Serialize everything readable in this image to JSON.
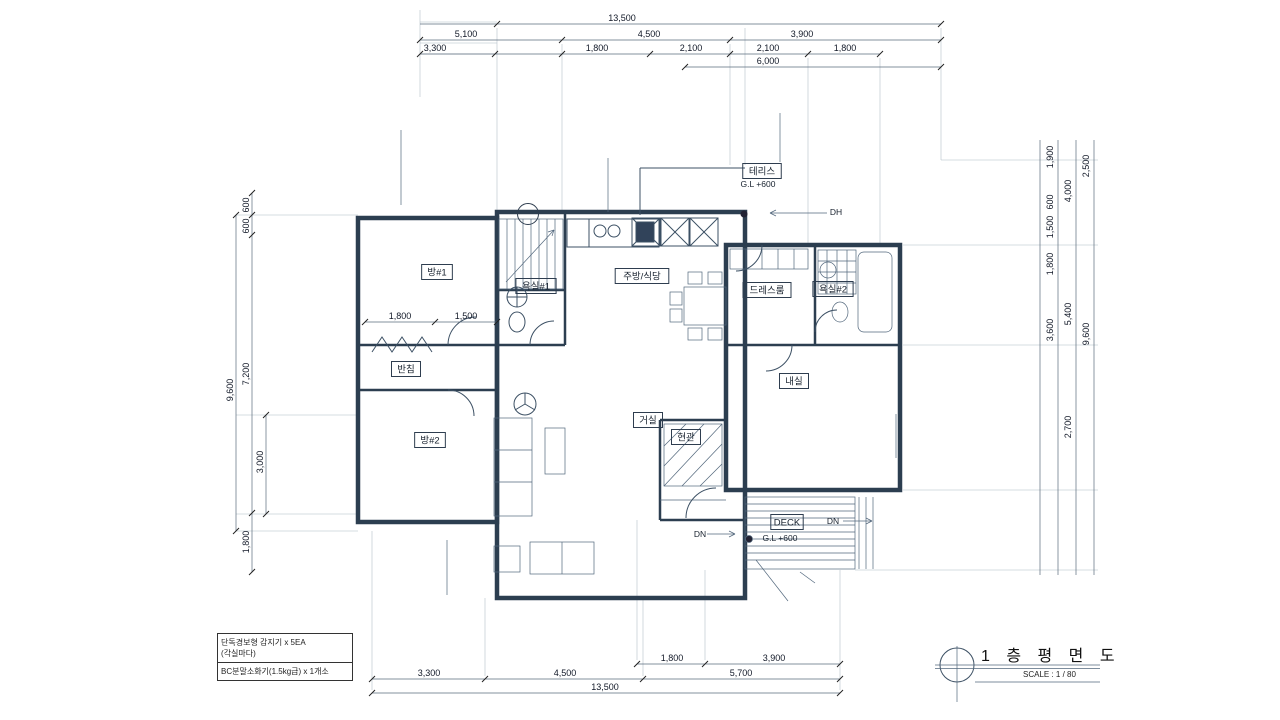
{
  "drawing_title": {
    "title": "1 층 평 면 도",
    "scale_label": "SCALE : 1 / 80"
  },
  "area_table": {
    "rows": [
      {
        "label": "공동주택 외",
        "values": [
          "65",
          "75",
          "90",
          "95"
        ]
      },
      {
        "label": "접하는 경우",
        "values": [
          "180",
          "215",
          "245",
          "270"
        ]
      },
      {
        "label": "접하는 경우",
        "values": [
          "120",
          "145",
          "165",
          "190"
        ]
      },
      {
        "label": "바닥난방인경우",
        "values": [
          "140",
          "165",
          "190",
          "210"
        ]
      },
      {
        "label": "바닥난방이 아닌경우",
        "values": [
          "130",
          "150",
          "175",
          "195"
        ]
      },
      {
        "label": "바닥난방인경우",
        "values": [
          "95",
          "110",
          "125",
          "140"
        ]
      },
      {
        "label": "바닥난방이 아닌경우",
        "values": [
          "90",
          "105",
          "120",
          "130"
        ]
      },
      {
        "label": "",
        "values": [
          "30",
          "35",
          "45",
          "50"
        ]
      }
    ]
  },
  "finish_schedule": {
    "rows": [
      {
        "room": [
          "내실",
          "방#1",
          "황토방"
        ],
        "lines": [
          "천정:경량철골천정틀위 9.5t석고보드위 천정지",
          "벽:9.5t 석고보드위 벽지마감",
          "걸레받이:H-100장판걸기",
          "바닥:세라믹온수온돌위 장판시공"
        ]
      },
      {
        "room": [
          "욕실"
        ],
        "lines": [
          "천정:PVC 천정재 설치(건축주지정품)",
          "벽:벽부용 도기질타일",
          "바닥:액체방수(2종)위 바닥용 자기질타일"
        ]
      },
      {
        "room": [
          "현관"
        ],
        "lines": [
          "천정:경량철골천정틀위 9.5t석고보드위 천정지",
          "벽:9.5t 석고보드위 벽지마감",
          "걸레받이:H=100 바닥재지정마감",
          "바닥:액체방수 자기질 타일 마감"
        ]
      }
    ]
  },
  "fire_equipment_box": {
    "line1": "단독경보형 감지기 x 5EA",
    "line2": "(각실마다)",
    "line3": "BC분말소화기(1.5kg급) x 1개소"
  },
  "wall_notes": [
    {
      "x": 397,
      "y": 126,
      "align": "right",
      "lines": [
        "외벽:스톤코트 마감(건축주지정)",
        "T=100 단열재(단열등급 '가'등급)",
        "T=200 콘크리트 벽체",
        "내부:모르타르위 벽지마감(건축주지정)"
      ]
    },
    {
      "x": 604,
      "y": 153,
      "align": "right",
      "lines": [
        "외벽:스톤코트 마감(건축주지정)",
        "T-100 단열재(단열등급 '가'등급)",
        "T=200 콘크리트 벽체",
        "내부:벽부용 도기질 타일 마감"
      ]
    },
    {
      "x": 784,
      "y": 108,
      "align": "left",
      "lines": [
        "외벽:스톤코트 마감(건축주지정)",
        "T=100 단열재(단열등급 '가'등급)",
        "T=200 콘크리트 벽체",
        "내부:모르타르위 벽지마감(건축주지정)"
      ]
    },
    {
      "x": 443,
      "y": 534,
      "align": "right",
      "lines": [
        "내부:모르타르위 벽지마감(건축주지정)",
        "T=200 콘크리트 벽체",
        "T-100 단열재(단열등급 가 등급)",
        "외벽:0.5B 전벽돌쌓기(건축주지정)"
      ]
    },
    {
      "x": 900,
      "y": 410,
      "align": "left",
      "lines": [
        "내부:모르타르위 벽지마감(건축주지정)",
        "T=200 콘크리트 벽체",
        "T=100 단열재(단열등급 '가'등급)",
        "외벽:0.5B 전벽돌쌓기(건축주지정)"
      ]
    },
    {
      "x": 508,
      "y": 612,
      "align": "left",
      "lines": [
        "외벽:0.5B 전벽돌쌓기(건축주지정)"
      ]
    },
    {
      "x": 818,
      "y": 579,
      "align": "left",
      "lines": [
        "방부목 난간대 설치"
      ]
    },
    {
      "x": 792,
      "y": 597,
      "align": "left",
      "lines": [
        "바닥:방부목 마감"
      ]
    }
  ],
  "room_labels": [
    {
      "t": "방#1",
      "x": 437,
      "y": 272
    },
    {
      "t": "욕실#1",
      "x": 536,
      "y": 286
    },
    {
      "t": "주방/식당",
      "x": 642,
      "y": 276
    },
    {
      "t": "드레스룸",
      "x": 767,
      "y": 290
    },
    {
      "t": "욕실#2",
      "x": 833,
      "y": 289
    },
    {
      "t": "내실",
      "x": 794,
      "y": 381
    },
    {
      "t": "거실",
      "x": 648,
      "y": 420
    },
    {
      "t": "현관",
      "x": 686,
      "y": 437
    },
    {
      "t": "방#2",
      "x": 430,
      "y": 440
    },
    {
      "t": "반침",
      "x": 406,
      "y": 369
    },
    {
      "t": "테리스",
      "x": 762,
      "y": 171
    },
    {
      "t": "DECK",
      "x": 787,
      "y": 522
    }
  ],
  "plain_labels": [
    {
      "t": "G.L +600",
      "x": 758,
      "y": 184
    },
    {
      "t": "G.L +600",
      "x": 780,
      "y": 538
    },
    {
      "t": "DH",
      "x": 836,
      "y": 212
    },
    {
      "t": "DN",
      "x": 833,
      "y": 521
    },
    {
      "t": "DN",
      "x": 700,
      "y": 534
    }
  ],
  "door_tags": [
    {
      "n": "8",
      "c": "PW",
      "x": 528,
      "y": 214
    },
    {
      "n": "5",
      "c": "PW",
      "x": 627,
      "y": 182
    },
    {
      "n": "2",
      "c": "PD",
      "x": 476,
      "y": 331
    },
    {
      "n": "3",
      "c": "PD",
      "x": 542,
      "y": 331
    },
    {
      "n": "2",
      "c": "PD",
      "x": 752,
      "y": 249
    },
    {
      "n": "3",
      "c": "PD",
      "x": 821,
      "y": 317
    },
    {
      "n": "6",
      "c": "PW",
      "x": 906,
      "y": 300
    },
    {
      "n": "2",
      "c": "PD",
      "x": 470,
      "y": 401
    },
    {
      "n": "3",
      "c": "PW",
      "x": 434,
      "y": 478
    },
    {
      "n": "1",
      "c": "AD",
      "x": 691,
      "y": 481
    },
    {
      "n": "4",
      "c": "PW",
      "x": 645,
      "y": 532
    },
    {
      "n": "2",
      "c": "PW",
      "x": 802,
      "y": 445
    },
    {
      "n": "1",
      "c": "PW",
      "x": 577,
      "y": 592
    },
    {
      "n": "3",
      "c": "PW",
      "x": 347,
      "y": 292
    }
  ],
  "sensors": [
    {
      "x": 432,
      "y": 293
    },
    {
      "x": 430,
      "y": 459
    },
    {
      "x": 604,
      "y": 299
    },
    {
      "x": 645,
      "y": 447
    },
    {
      "x": 803,
      "y": 398
    }
  ],
  "dims": {
    "top_rows": [
      {
        "y": 24,
        "x1": 420,
        "x2": 941,
        "ticks": [
          497,
          941
        ],
        "labels": [
          {
            "t": "13,500",
            "x": 622
          }
        ]
      },
      {
        "y": 40,
        "x1": 420,
        "x2": 941,
        "ticks": [
          420,
          562,
          730,
          941
        ],
        "labels": [
          {
            "t": "5,100",
            "x": 466
          },
          {
            "t": "4,500",
            "x": 649
          },
          {
            "t": "3,900",
            "x": 802
          }
        ]
      },
      {
        "y": 54,
        "x1": 420,
        "x2": 880,
        "ticks": [
          420,
          495,
          562,
          650,
          730,
          808,
          880
        ],
        "labels": [
          {
            "t": "3,300",
            "x": 435
          },
          {
            "t": "1,800",
            "x": 597
          },
          {
            "t": "2,100",
            "x": 691
          },
          {
            "t": "2,100",
            "x": 768
          },
          {
            "t": "1,800",
            "x": 845
          }
        ]
      },
      {
        "y": 67,
        "x1": 685,
        "x2": 941,
        "ticks": [
          685,
          941
        ],
        "labels": [
          {
            "t": "6,000",
            "x": 768
          }
        ]
      }
    ],
    "bottom_rows": [
      {
        "y": 664,
        "x1": 637,
        "x2": 840,
        "ticks": [
          637,
          705,
          840
        ],
        "labels": [
          {
            "t": "1,800",
            "x": 672
          },
          {
            "t": "3,900",
            "x": 774
          }
        ]
      },
      {
        "y": 679,
        "x1": 372,
        "x2": 840,
        "ticks": [
          372,
          485,
          643,
          840
        ],
        "labels": [
          {
            "t": "3,300",
            "x": 429
          },
          {
            "t": "4,500",
            "x": 565
          },
          {
            "t": "5,700",
            "x": 741
          }
        ]
      },
      {
        "y": 693,
        "x1": 372,
        "x2": 840,
        "ticks": [
          372,
          840
        ],
        "labels": [
          {
            "t": "13,500",
            "x": 605
          }
        ]
      }
    ],
    "inner_rows": [
      {
        "y": 322,
        "x1": 365,
        "x2": 497,
        "ticks": [
          365,
          435,
          497
        ],
        "labels": [
          {
            "t": "1,800",
            "x": 400
          },
          {
            "t": "1,500",
            "x": 466
          }
        ]
      }
    ],
    "left_cols": [
      {
        "x": 236,
        "y1": 215,
        "y2": 531,
        "ticks": [
          215,
          531
        ],
        "labels": [
          {
            "t": "9,600",
            "y": 390
          }
        ]
      },
      {
        "x": 252,
        "y1": 193,
        "y2": 572,
        "ticks": [
          193,
          215,
          235,
          513,
          572
        ],
        "labels": [
          {
            "t": "600",
            "y": 205
          },
          {
            "t": "600",
            "y": 226
          },
          {
            "t": "7,200",
            "y": 374
          },
          {
            "t": "1,800",
            "y": 542
          }
        ]
      },
      {
        "x": 266,
        "y1": 415,
        "y2": 514,
        "ticks": [
          415,
          514
        ],
        "labels": [
          {
            "t": "3,000",
            "y": 462
          }
        ]
      }
    ],
    "right_lines": [
      1040,
      1058,
      1076,
      1094
    ],
    "right_labels": [
      {
        "t": "1,900",
        "x": 1053,
        "y": 157
      },
      {
        "t": "600",
        "x": 1053,
        "y": 202
      },
      {
        "t": "1,500",
        "x": 1053,
        "y": 227
      },
      {
        "t": "1,800",
        "x": 1053,
        "y": 264
      },
      {
        "t": "3,600",
        "x": 1053,
        "y": 330
      },
      {
        "t": "4,000",
        "x": 1071,
        "y": 191
      },
      {
        "t": "5,400",
        "x": 1071,
        "y": 314
      },
      {
        "t": "2,700",
        "x": 1071,
        "y": 427
      },
      {
        "t": "2,500",
        "x": 1089,
        "y": 166
      },
      {
        "t": "9,600",
        "x": 1089,
        "y": 334
      }
    ]
  },
  "annotations": {
    "colors": {
      "red": "#c23a52",
      "blue": "#1f78cc",
      "highlight": "#7fb2e0",
      "bar": "#1a6ab9"
    },
    "highlight_rects": [
      {
        "x": 348,
        "y": 205,
        "w": 140,
        "h": 323
      },
      {
        "x": 475,
        "y": 155,
        "w": 270,
        "h": 445
      },
      {
        "x": 726,
        "y": 240,
        "w": 177,
        "h": 255
      }
    ],
    "highlight_bar": {
      "x": 348,
      "y": 366,
      "w": 570,
      "h": 10
    },
    "circles": [
      {
        "x": 642,
        "y": 259,
        "r": 15,
        "color": "red"
      },
      {
        "x": 847,
        "y": 311,
        "r": 15,
        "color": "red"
      },
      {
        "x": 640,
        "y": 417,
        "r": 16,
        "color": "red"
      },
      {
        "x": 474,
        "y": 293,
        "r": 14,
        "color": "blue"
      },
      {
        "x": 758,
        "y": 294,
        "r": 15,
        "color": "blue"
      },
      {
        "x": 470,
        "y": 412,
        "r": 13,
        "color": "blue"
      },
      {
        "x": 472,
        "y": 471,
        "r": 15,
        "color": "blue"
      },
      {
        "x": 758,
        "y": 390,
        "r": 15,
        "color": "blue"
      },
      {
        "x": 758,
        "y": 437,
        "r": 15,
        "color": "blue"
      },
      {
        "x": 546,
        "y": 557,
        "r": 13,
        "color": "blue"
      }
    ]
  }
}
